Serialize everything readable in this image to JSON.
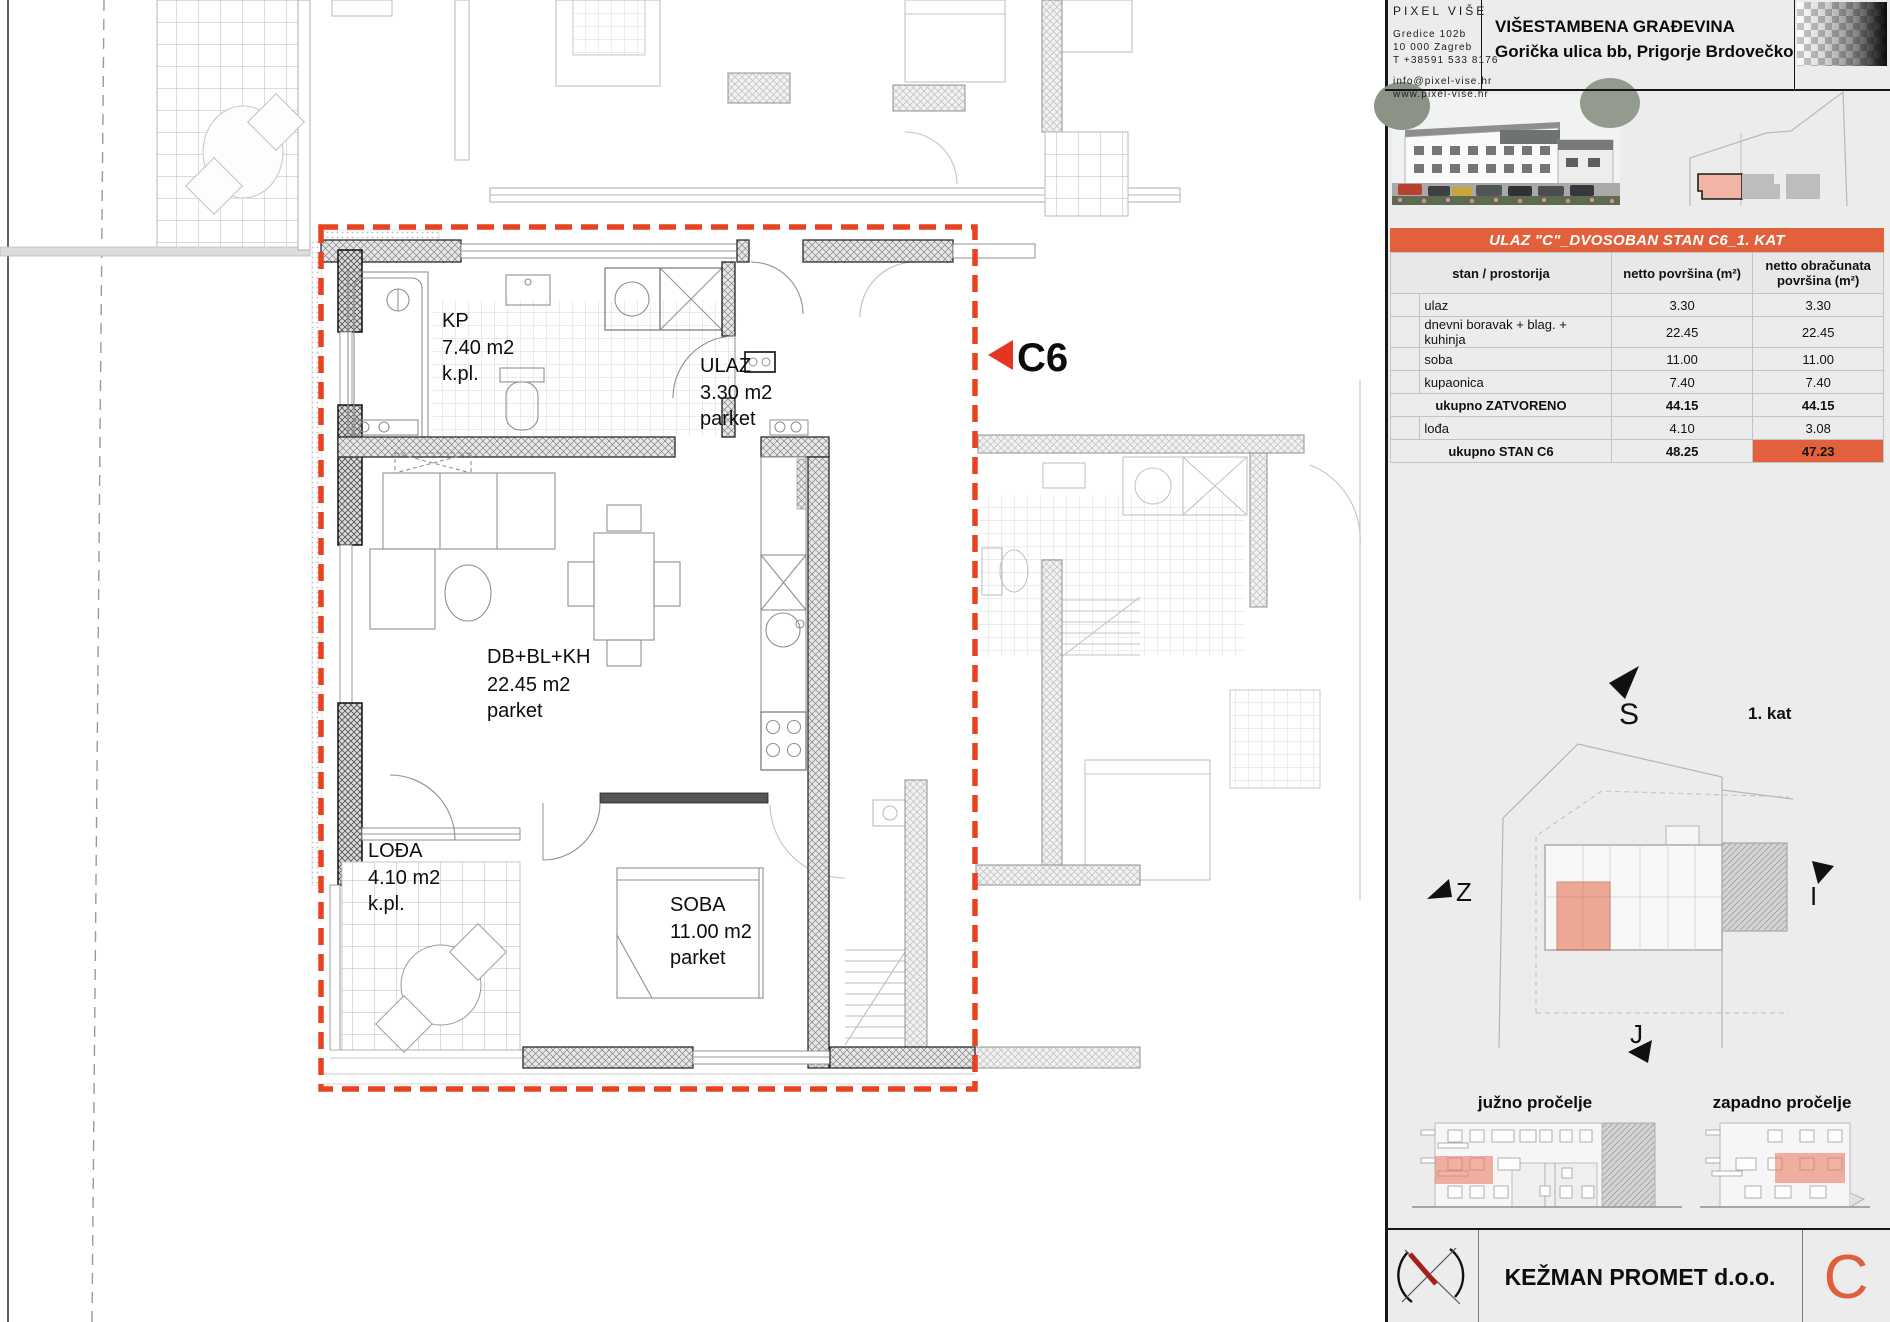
{
  "header": {
    "company": {
      "name": "PIXEL VIŠE",
      "address1": "Gredice 102b",
      "address2": "10 000 Zagreb",
      "phone": "T +38591 533 8176",
      "email": "info@pixel-vise.hr",
      "website": "www.pixel-vise.hr"
    },
    "project_title": "VIŠESTAMBENA GRAĐEVINA",
    "project_address": "Gorička ulica bb, Prigorje Brdovečko"
  },
  "unit_banner": {
    "title": "ULAZ \"C\"_DVOSOBAN STAN C6_1. KAT"
  },
  "area_table": {
    "columns": {
      "room": "stan / prostorija",
      "net": "netto površina (m²)",
      "accounted": "netto obračunata površina (m²)"
    },
    "rows": [
      {
        "room": "ulaz",
        "net": "3.30",
        "accounted": "3.30"
      },
      {
        "room": "dnevni boravak + blag. + kuhinja",
        "net": "22.45",
        "accounted": "22.45"
      },
      {
        "room": "soba",
        "net": "11.00",
        "accounted": "11.00"
      },
      {
        "room": "kupaonica",
        "net": "7.40",
        "accounted": "7.40"
      },
      {
        "room": "ukupno ZATVORENO",
        "net": "44.15",
        "accounted": "44.15"
      },
      {
        "room": "lođa",
        "net": "4.10",
        "accounted": "3.08"
      },
      {
        "room": "ukupno STAN C6",
        "net": "48.25",
        "accounted": "47.23"
      }
    ]
  },
  "floor_plan": {
    "unit_marker": "C6",
    "rooms": {
      "kupaonica": {
        "abbr": "KP",
        "area": "7.40 m2",
        "floor": "k.pl."
      },
      "ulaz": {
        "abbr": "ULAZ",
        "area": "3.30 m2",
        "floor": "parket"
      },
      "dnevni": {
        "abbr": "DB+BL+KH",
        "area": "22.45 m2",
        "floor": "parket"
      },
      "lodja": {
        "abbr": "LOĐA",
        "area": "4.10 m2",
        "floor": "k.pl."
      },
      "soba": {
        "abbr": "SOBA",
        "area": "11.00 m2",
        "floor": "parket"
      }
    }
  },
  "orientation": {
    "north": "S",
    "west": "Z",
    "east": "I",
    "south": "J",
    "floor_label": "1. kat"
  },
  "elevations": {
    "south_label": "južno pročelje",
    "west_label": "zapadno pročelje"
  },
  "footer": {
    "developer": "KEŽMAN PROMET d.o.o.",
    "section_mark": "C"
  },
  "colors": {
    "accent": "#E2603C",
    "boundary_red": "#E8431F",
    "unit_pink": "#F2B5A5"
  }
}
